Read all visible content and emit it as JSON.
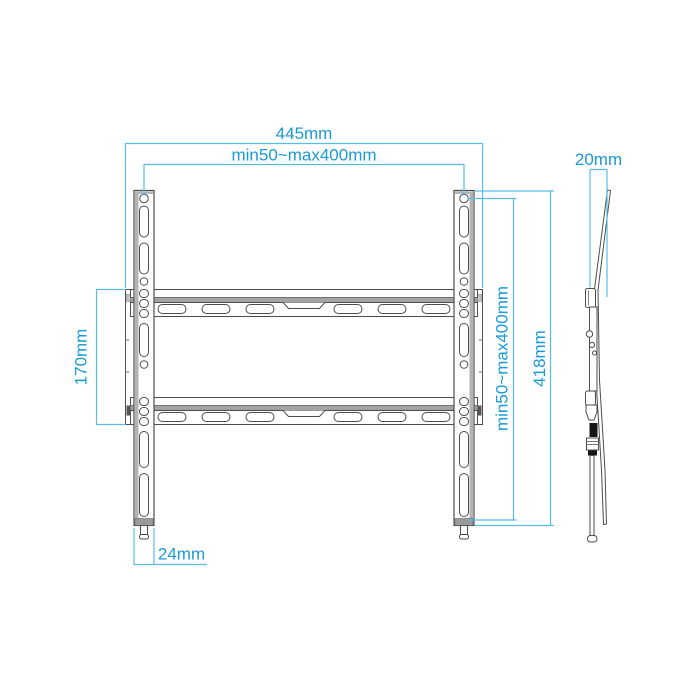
{
  "dimensions": {
    "overall_width": "445mm",
    "hole_pattern_width": "min50~max400mm",
    "profile_depth": "20mm",
    "wall_plate_height": "170mm",
    "hole_pattern_height": "min50~max400mm",
    "bracket_height": "418mm",
    "bracket_arm_width": "24mm"
  },
  "colors": {
    "dimension_line": "#56BDE9",
    "dimension_text": "#1A9AD6",
    "outline": "#4D4D4D",
    "shading_gray": "#A3A3A3",
    "background": "#FFFFFF"
  }
}
